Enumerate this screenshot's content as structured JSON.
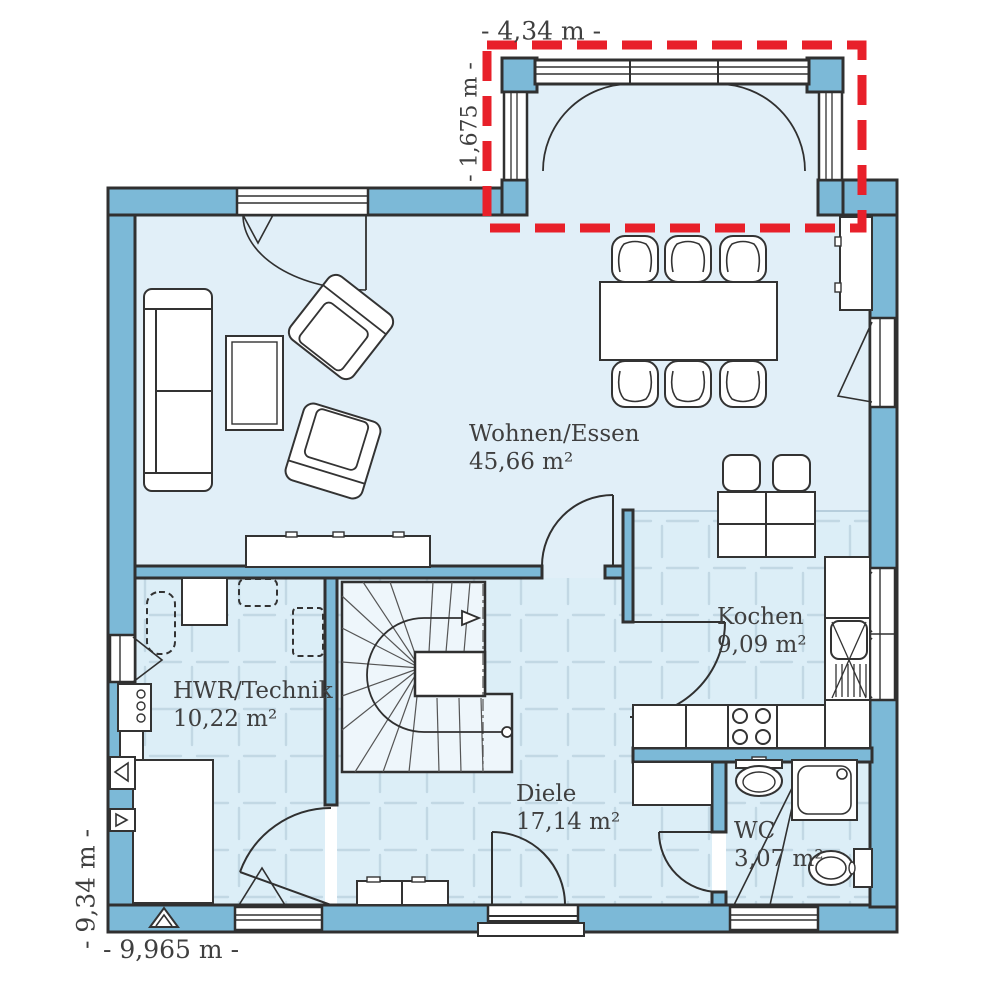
{
  "plan": {
    "rooms": [
      {
        "name": "Wohnen/Essen",
        "area": "45,66 m²"
      },
      {
        "name": "Kochen",
        "area": "9,09 m²"
      },
      {
        "name": "HWR/Technik",
        "area": "10,22 m²"
      },
      {
        "name": "Diele",
        "area": "17,14 m²"
      },
      {
        "name": "WC",
        "area": "3,07 m²"
      }
    ],
    "dimensions": {
      "bay_width": "- 4,34 m -",
      "bay_depth": "- 1,675 m -",
      "house_depth": "- 9,34 m -",
      "house_width": "- 9,965 m -"
    },
    "colors": {
      "wall": "#7cb9d7",
      "outline": "#303030",
      "floor": "#e1eff8",
      "floor_tiled": "#dceef7",
      "tile_line": "#c2d8e4",
      "marker_red": "#e8202a",
      "text": "#3f3f3f"
    }
  }
}
